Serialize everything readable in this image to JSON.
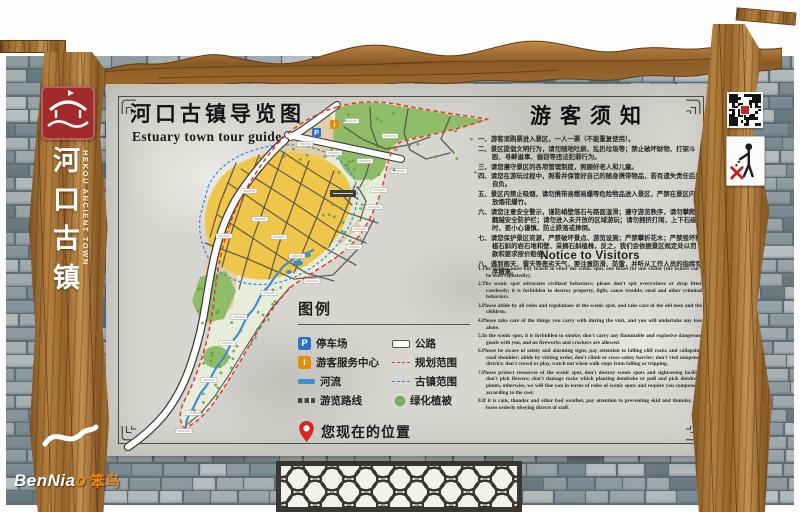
{
  "brand": {
    "plank_title_cn": "河口古镇",
    "plank_title_en": "HEKOU ANCIENT TOWN",
    "benniao_en": "BenNia",
    "benniao_o": "o",
    "benniao_cn": "笨鸟"
  },
  "panel": {
    "title_cn": "河口古镇导览图",
    "title_en": "Estuary town tour guide"
  },
  "map": {
    "parking_symbol": "P",
    "info_symbol": "i"
  },
  "legend": {
    "title": "图例",
    "left": [
      {
        "symbol": "P",
        "label": "停车场"
      },
      {
        "symbol": "i",
        "label": "游客服务中心"
      },
      {
        "label": "河流"
      },
      {
        "label": "游览路线"
      }
    ],
    "right": [
      {
        "label": "公路"
      },
      {
        "label": "规划范围"
      },
      {
        "label": "古镇范围"
      },
      {
        "label": "绿化植被"
      }
    ],
    "current_location": "您现在的位置"
  },
  "notice_cn": {
    "title": "游客须知",
    "items": [
      "一、游客须购票进入景区，一人一票（不能重复使用）。",
      "二、景区提倡文明行为，请勿随地吐痰、乱扔垃圾等；禁止破坏财物、打架斗殴、寻衅滋事、偷窃等违法犯罪行为。",
      "三、请您遵守景区的各项管理制度，照顾好老人和儿童。",
      "四、请您在游玩过程中，照看并保管好自己的随身携带物品，若有遗失责任后果自负。",
      "五、景区内禁止吸烟，请勿携带易燃易爆等危险物品进入景区，严禁在景区内燃放烟花爆竹。",
      "六、请您注意安全警示，谨防峭壁落石与路面湿滑；遵守游览秩序，请勿攀爬、翻越安全防护栏；请勿进入未开放的区域游玩；请勿拥挤打闹，上下石级时，要小心谨慎，防止跌落或摔倒。",
      "七、请您保护景区资源，严禁破坏景点、游览设施；严禁攀折花木；严禁毁坏种植石斛的岩石堆和壁、采摘石斛植株，反之，我们会依据景区规定处以罚款和要求按价赔偿。",
      "八、遇到雨天、雷天等恶劣天气，要注意防滑、防雷，并听从工作人员的指挥有序撤离。"
    ]
  },
  "notice_en": {
    "title": "Notice to Visitors",
    "items": [
      "1.The visitors must buy tickets to enter the scenic spot, one ticket for one visitor (the tickets can't be used repeatedly).",
      "2.The scenic spot advocates civilized behaviors; please don't spit everywhere or drop litter carelessly; it is forbidden to destroy property, fight, cause trouble, steal and other criminal behaviors.",
      "3.Please abide by all rules and regulations of the scenic spot, and take care of the old men and the children.",
      "4.Please take care of the things you carry with during the visit, and you will undertake any loss alone.",
      "5.In the scenic spot, it is forbidden to smoke; don't carry any flammable and explosive dangerous goods with you, and no fireworks and crackers are allowed.",
      "6.Please be aware of safety and alarming signs, pay attention to falling cliff rocks and collapsing road shoulder; abide by visiting order, don't climb or cross safety barrier; don't visit unopened district; don't crowd or play, watch out when walk steps from falling or tripping.",
      "7.Please protect resources of the scenic spot, don't destroy scenic spots and sightseeing facility; don't pick flowers; don't damage rocks which planting dendrobe or pull and pick dendrobe plants, otherwise, we will fine you in terms of rules of scenic spots and require you compensate according to the cost.",
      "8.If it is rain, thunder and other bad weather, pay attention to preventing skid and thunder, and leave orderly obeying directs of staff."
    ]
  },
  "colors": {
    "map_yellow": "#f0c64a",
    "map_green": "#8fbc67",
    "map_tan": "#e0cba5",
    "river_blue": "#3f8fd0",
    "boundary_red": "#e23b2e",
    "boundary_blue": "#3f86d8",
    "parking_blue": "#2e6fd0",
    "info_orange": "#e8890c",
    "seal_red": "#a32a2b",
    "accent_orange": "#f08519",
    "pin_red": "#d8271d"
  }
}
